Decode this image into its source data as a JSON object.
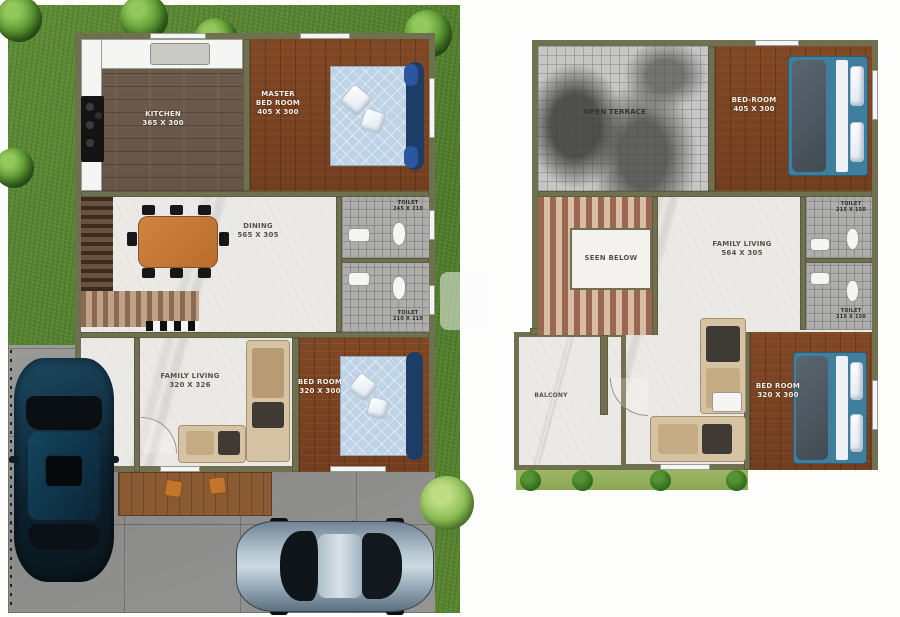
{
  "ground": {
    "kitchen": {
      "name": "KITCHEN",
      "dim": "365 X 300"
    },
    "master_bedroom": {
      "name": "MASTER BED ROOM",
      "dim": "405 X 300"
    },
    "dining": {
      "name": "DINING",
      "dim": "565 X 305"
    },
    "toilet_top": {
      "name": "TOILET",
      "dim": "245 X 210"
    },
    "toilet_bottom": {
      "name": "TOILET",
      "dim": "210 X 210"
    },
    "family_living": {
      "name": "FAMILY LIVING",
      "dim": "320 X 326"
    },
    "bedroom": {
      "name": "BED ROOM",
      "dim": "320 X 300"
    }
  },
  "first": {
    "open_terrace": {
      "name": "OPEN TERRACE"
    },
    "bedroom_top": {
      "name": "BED-ROOM",
      "dim": "405 X 300"
    },
    "stairwell": {
      "name": "SEEN BELOW"
    },
    "family_living": {
      "name": "FAMILY LIVING",
      "dim": "564 X 305"
    },
    "toilet_top": {
      "name": "TOILET",
      "dim": "215 X 150"
    },
    "toilet_bottom": {
      "name": "TOILET",
      "dim": "215 X 150"
    },
    "balcony": {
      "name": "BALCONY"
    },
    "bedroom_bottom": {
      "name": "BED ROOM",
      "dim": "320 X 300"
    }
  },
  "colors": {
    "grass": "#5b8733",
    "wall_olive": "#6f7050",
    "marble": "#ebe9e5",
    "wood_red": "#7c4526",
    "wood_gray": "#695748",
    "tile_gray": "#adadab",
    "driveway": "#909090",
    "bed_blue": "#3f86a5",
    "suv_teal": "#123a4e",
    "sedan_silver": "#a9bcca"
  }
}
